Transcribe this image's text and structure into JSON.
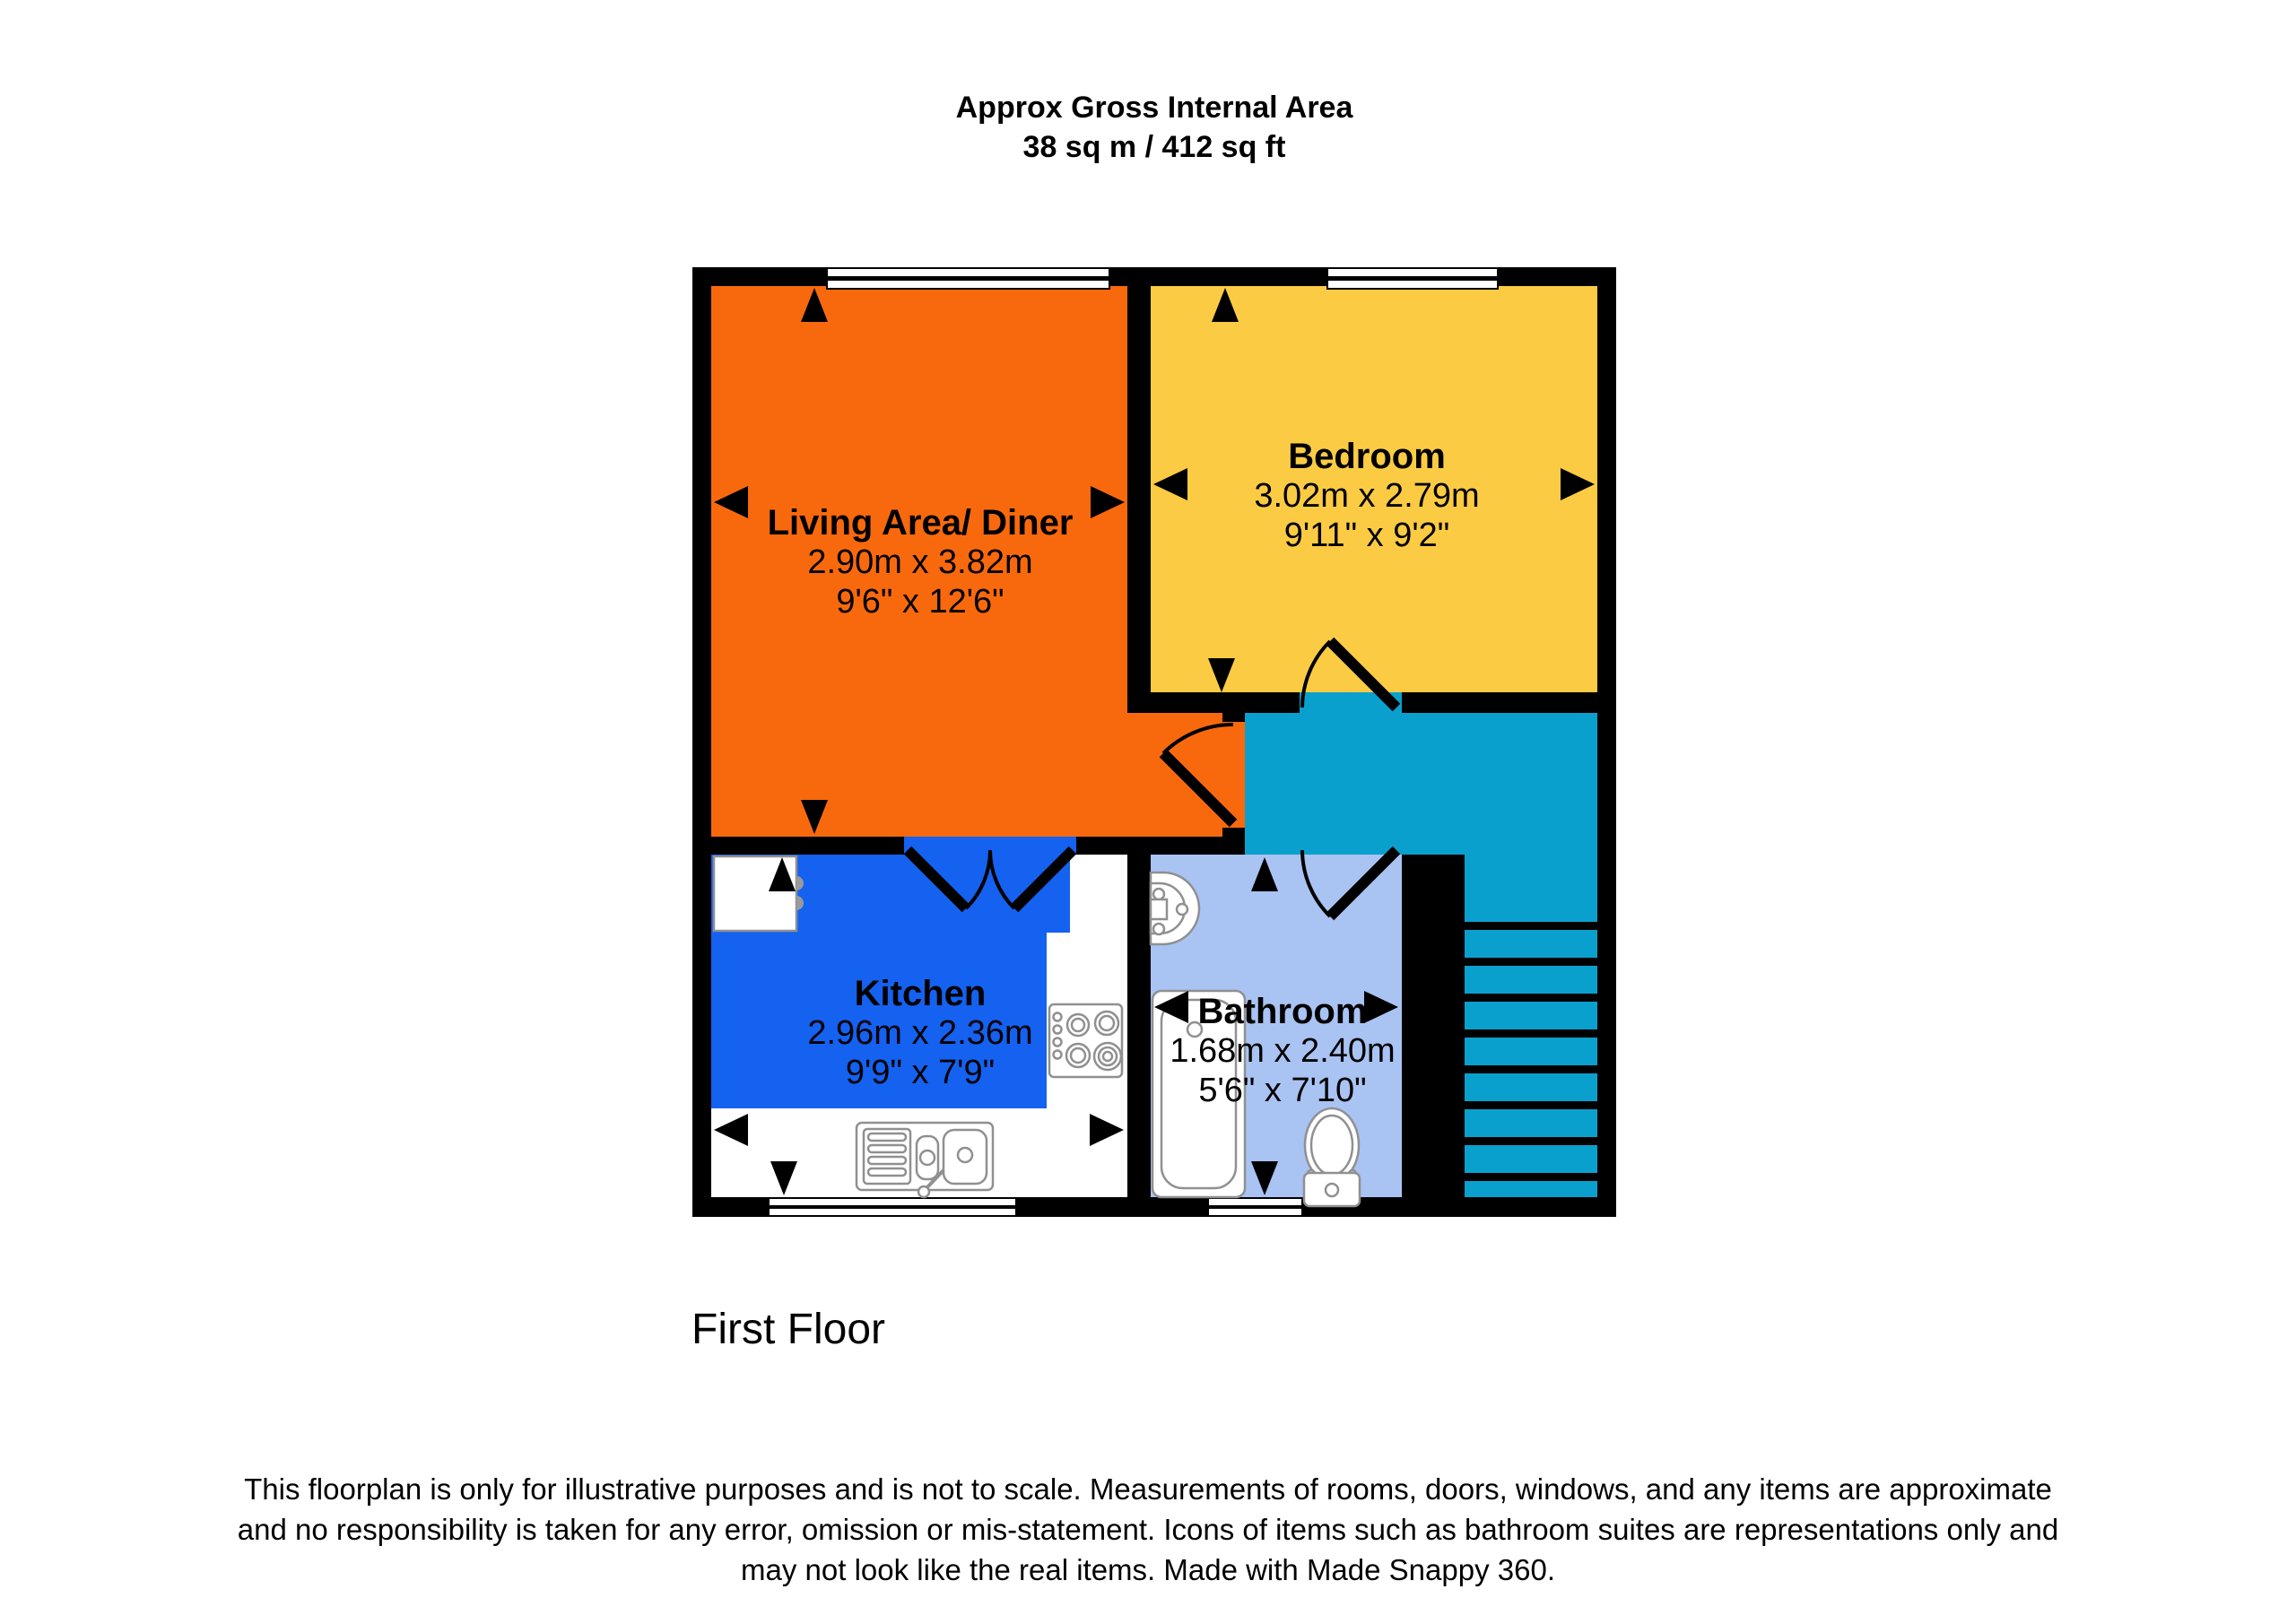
{
  "title": {
    "line1": "Approx Gross Internal Area",
    "line2": "38 sq m / 412 sq ft"
  },
  "floor_label": "First Floor",
  "rooms": [
    {
      "name": "Living Area/ Diner",
      "metric": "2.90m x 3.82m",
      "imperial": "9'6\" x 12'6\""
    },
    {
      "name": "Bedroom",
      "metric": "3.02m x 2.79m",
      "imperial": "9'11\" x 9'2\""
    },
    {
      "name": "Kitchen",
      "metric": "2.96m x 2.36m",
      "imperial": "9'9\" x 7'9\""
    },
    {
      "name": "Bathroom",
      "metric": "1.68m x 2.40m",
      "imperial": "5'6\" x 7'10\""
    }
  ],
  "colors": {
    "living": "#f8690d",
    "bedroom": "#fbcb43",
    "kitchen": "#1561f0",
    "bathroom": "#a9c3f3",
    "hall": "#0aa0ce",
    "wall": "#000000"
  },
  "disclaimer": {
    "line1": "This floorplan is only for illustrative purposes and is not to scale. Measurements of rooms, doors, windows, and any items are approximate",
    "line2": "and no responsibility is taken for any error, omission or mis-statement. Icons of items such as bathroom suites are representations only and",
    "line3": "may not look like the real items. Made with Made Snappy 360."
  }
}
